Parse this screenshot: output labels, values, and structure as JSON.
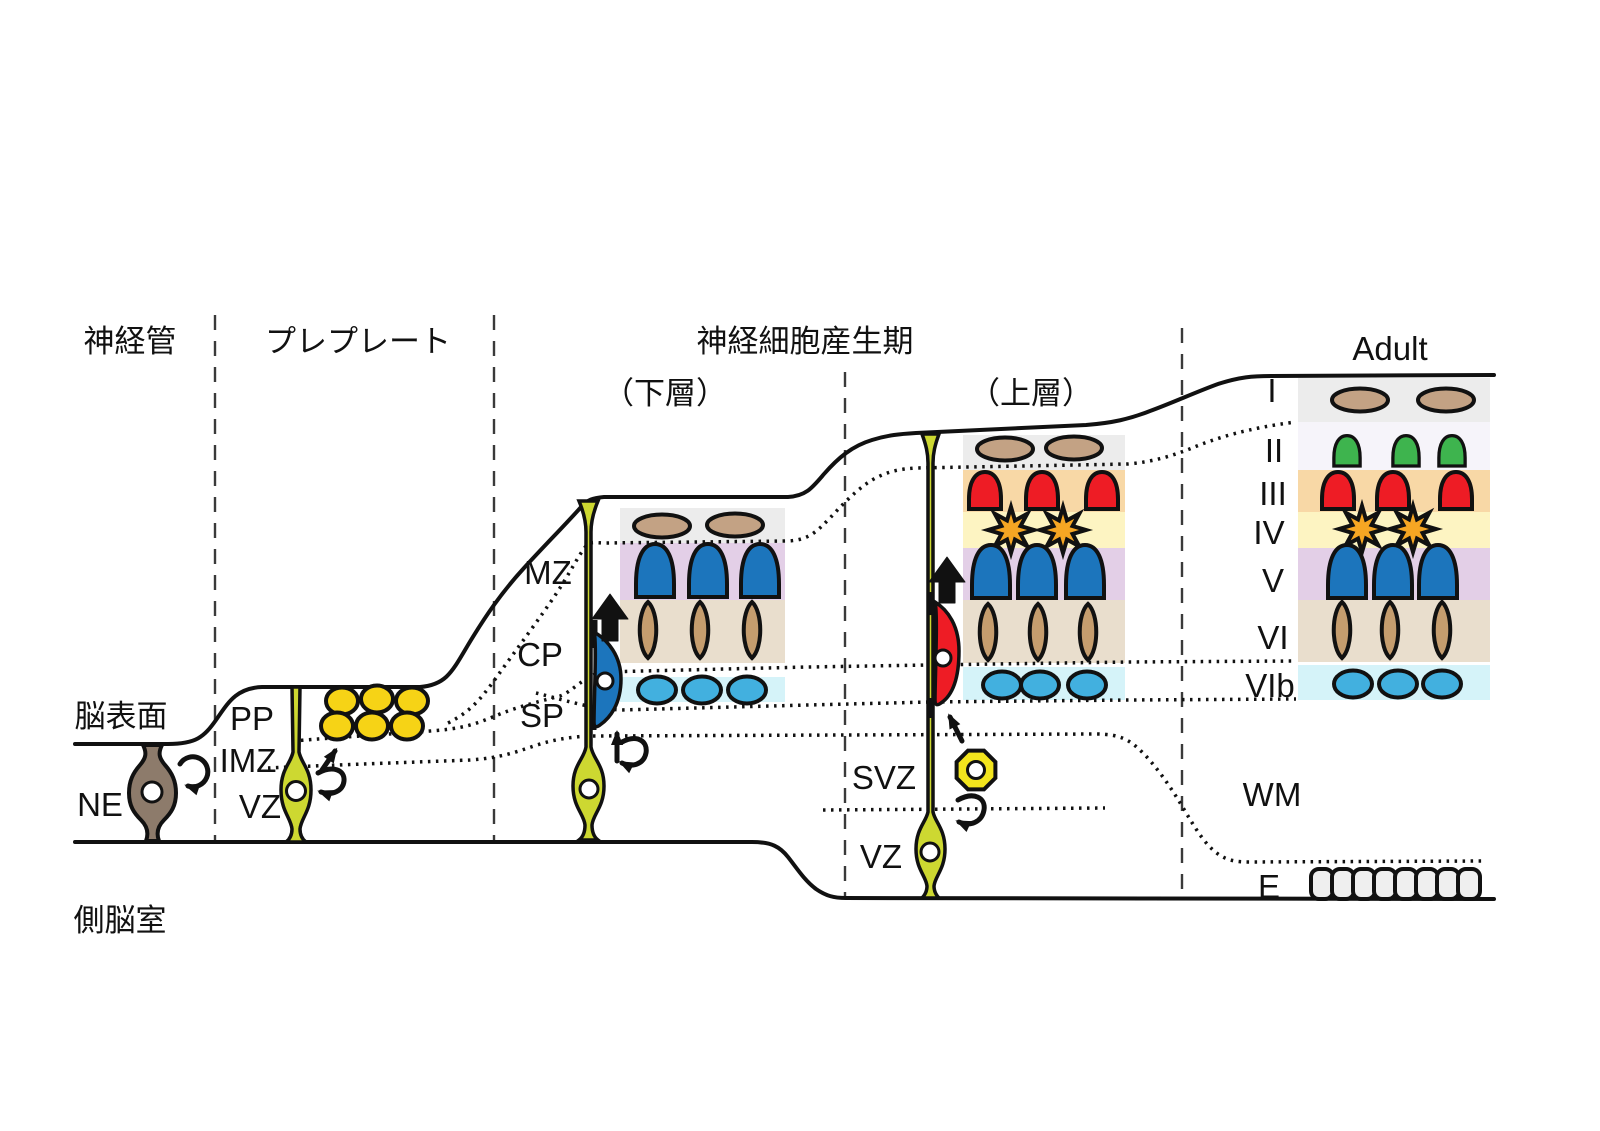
{
  "figure": {
    "title_row": {
      "neural_tube": "神経管",
      "preplate": "プレプレート",
      "neurogenesis": "神経細胞産生期",
      "deep_layers": "（下層）",
      "upper_layers": "（上層）",
      "adult": "Adult"
    },
    "anatomy": {
      "brain_surface": "脳表面",
      "lateral_ventricle": "側脳室"
    },
    "zones": {
      "ne": "NE",
      "pp": "PP",
      "imz": "IMZ",
      "vz": "VZ",
      "mz": "MZ",
      "cp": "CP",
      "sp": "SP",
      "svz": "SVZ",
      "vz_late": "VZ",
      "wm": "WM",
      "ependyma": "E"
    },
    "adult_layers": {
      "l1": "I",
      "l2": "II",
      "l3": "III",
      "l4": "IV",
      "l5": "V",
      "l6": "VI",
      "l6b": "VIb"
    },
    "colors": {
      "neuroepithelial_cell": "#8d7b6b",
      "radial_glia": "#cdd831",
      "preplate_neuron": "#f6d316",
      "intermediate_progenitor": "#f3e51d",
      "cajal_retzius": "#c3a284",
      "layer2_neuron": "#3eb44e",
      "layer3_neuron": "#ee1c25",
      "layer4_neuron": "#f6a623",
      "layer5_neuron": "#1c75bc",
      "layer6_neuron": "#c59d6e",
      "subplate_neuron": "#42b0df",
      "ependymal_cell": "#efefef",
      "band_i": "#ececec",
      "band_ii": "#f6f4fa",
      "band_iii": "#f8d8a6",
      "band_iv": "#fdf4c2",
      "band_v": "#e3cfe7",
      "band_vi": "#e9decd",
      "band_vib": "#d5f3f9"
    }
  }
}
